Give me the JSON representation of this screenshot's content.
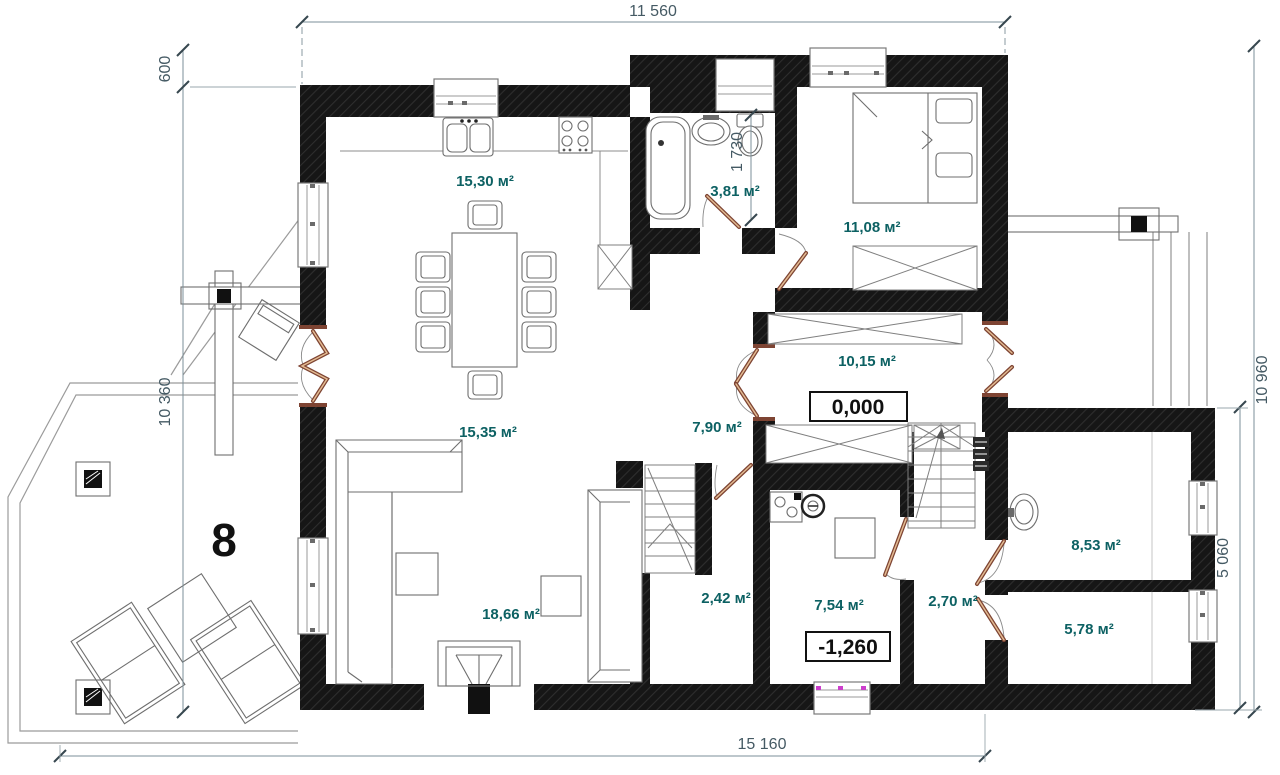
{
  "rooms": {
    "kitchen_dining": {
      "area": "15,30 м²"
    },
    "bathroom": {
      "area": "3,81 м²"
    },
    "bedroom": {
      "area": "11,08 м²"
    },
    "hall": {
      "area": "10,15 м²"
    },
    "corridor": {
      "area": "7,90 м²"
    },
    "living_upper": {
      "area": "15,35 м²"
    },
    "living_lower": {
      "area": "18,66 м²"
    },
    "stair_room": {
      "area": "2,42 м²"
    },
    "boiler_room": {
      "area": "7,54 м²"
    },
    "lobby": {
      "area": "2,70 м²"
    },
    "room_a": {
      "area": "8,53 м²"
    },
    "room_b": {
      "area": "5,78 м²"
    }
  },
  "levels": {
    "ground": "0,000",
    "lowered": "-1,260"
  },
  "dimensions": {
    "top_width": "11 560",
    "left_offset": "600",
    "left_height": "10 360",
    "right_height": "10 960",
    "wing_height": "5 060",
    "bottom_width": "15 160",
    "bathroom_width": "1 730"
  },
  "annotations": {
    "terrace_number": "8"
  },
  "colors": {
    "wall": "#1a1a1a",
    "area_label": "#0d6163",
    "dimension_text": "#455a64",
    "door_leaf": "#7e4433",
    "window_accent": "#cc3fcc",
    "level_text": "#101010"
  }
}
